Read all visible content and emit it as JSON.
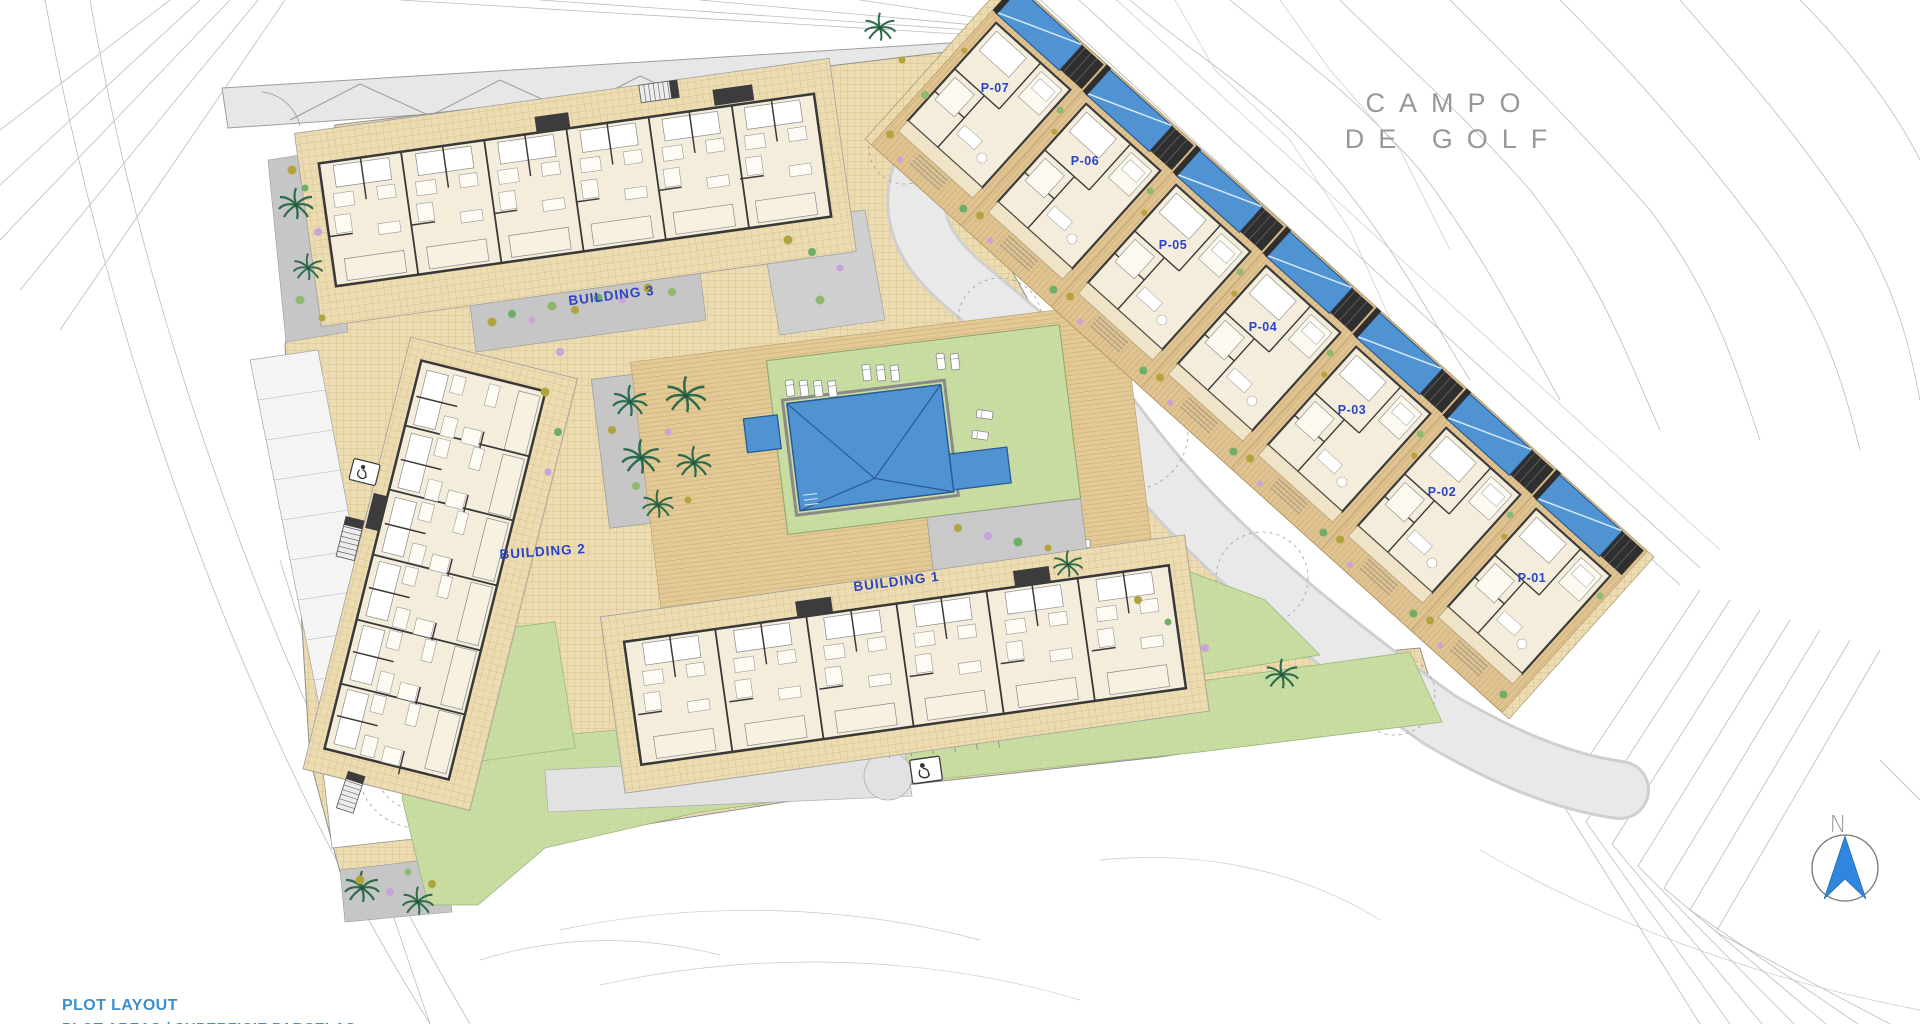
{
  "golf_area": {
    "label_line1": "CAMPO",
    "label_line2": "DE GOLF"
  },
  "buildings": [
    {
      "label": "BUILDING 3"
    },
    {
      "label": "BUILDING 2"
    },
    {
      "label": "BUILDING 1"
    }
  ],
  "plots": [
    {
      "label": "P-07"
    },
    {
      "label": "P-06"
    },
    {
      "label": "P-05"
    },
    {
      "label": "P-04"
    },
    {
      "label": "P-03"
    },
    {
      "label": "P-02"
    },
    {
      "label": "P-01"
    }
  ],
  "compass": {
    "north_label": "N"
  },
  "title_block": {
    "line1": "PLOT LAYOUT",
    "line2": "PLOT AREAS / SUPERFICIE PARCELAS"
  },
  "colors": {
    "paving_tan": "#ecdcb2",
    "deck_wood": "#e2c995",
    "lawn_green": "#c9dda3",
    "pool_blue": "#4f93d2",
    "road_gray": "#e9e9e9",
    "courtyard_gray": "#c6c6c6",
    "wall_dark": "#3b3b3b",
    "interior_cream": "#f4eddc",
    "label_blue": "#2b44c4",
    "golf_text_gray": "#94999e",
    "title_text_blue": "#3e8ec9",
    "north_arrow_blue": "#2e86de",
    "palm_green": "#2e6b4a"
  }
}
